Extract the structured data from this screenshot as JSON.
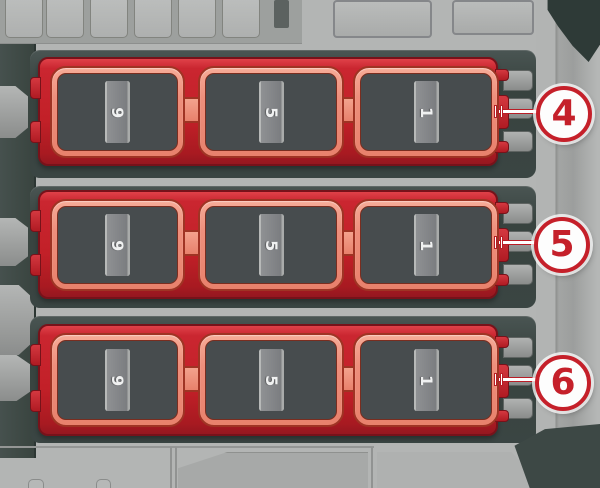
{
  "fuse_panel": {
    "rows": [
      {
        "callout": "4",
        "groups": [
          {
            "fuses": [
              "12",
              "11",
              "10",
              "9"
            ]
          },
          {
            "fuses": [
              "8",
              "7",
              "6",
              "5"
            ]
          },
          {
            "fuses": [
              "4",
              "3",
              "2",
              "1"
            ]
          }
        ]
      },
      {
        "callout": "5",
        "groups": [
          {
            "fuses": [
              "12",
              "11",
              "10",
              "9"
            ]
          },
          {
            "fuses": [
              "8",
              "7",
              "6",
              "5"
            ]
          },
          {
            "fuses": [
              "4",
              "3",
              "2",
              "1"
            ]
          }
        ]
      },
      {
        "callout": "6",
        "groups": [
          {
            "fuses": [
              "12",
              "11",
              "10",
              "9"
            ]
          },
          {
            "fuses": [
              "8",
              "7",
              "6",
              "5"
            ]
          },
          {
            "fuses": [
              "4",
              "3",
              "2",
              "1"
            ]
          }
        ]
      }
    ],
    "colors": {
      "block_red": "#c22028",
      "frame_salmon": "#ee8f7c",
      "slot_gray": "#85878a",
      "panel_dark_teal": "#3a4543",
      "background_gray": "#b3b5b4",
      "callout_red": "#c5202a",
      "number_white": "#f0f1f1"
    }
  }
}
